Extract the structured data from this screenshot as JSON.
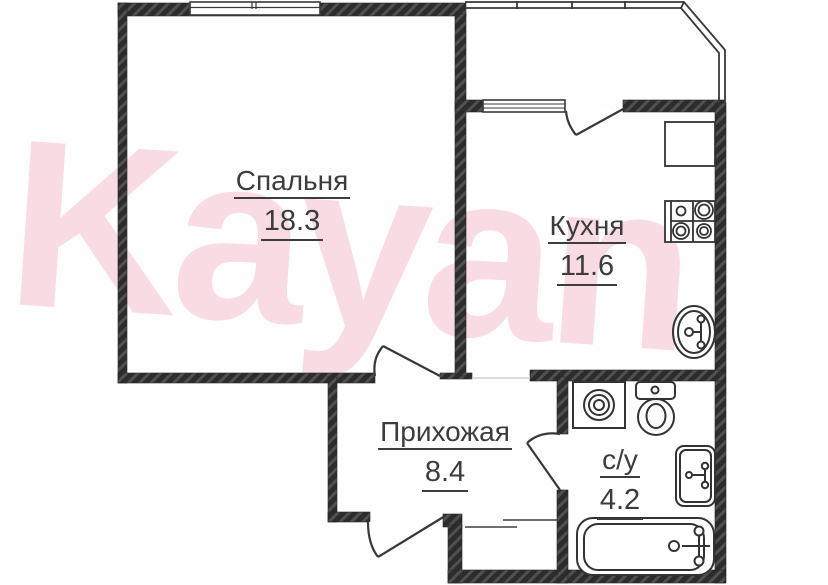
{
  "watermark": {
    "text": "Kayan",
    "color": "#f8dbe3"
  },
  "plan": {
    "type": "apartment-floor-plan",
    "rooms": [
      {
        "name": "Спальня",
        "area": "18.3"
      },
      {
        "name": "Кухня",
        "area": "11.6"
      },
      {
        "name": "Прихожая",
        "area": "8.4"
      },
      {
        "name": "с/у",
        "area": "4.2"
      }
    ],
    "fixtures": [
      "stove-icon",
      "kitchen-counter",
      "kitchen-sink-icon",
      "washing-machine-icon",
      "toilet-icon",
      "wash-basin-icon",
      "bathtub-icon"
    ],
    "features": [
      "bedroom-window",
      "kitchen-window",
      "balcony-glazing",
      "bedroom-door",
      "balcony-door",
      "bathroom-door",
      "entrance-door",
      "entrance-threshold"
    ]
  },
  "colors": {
    "wall": "#2c2c2c",
    "wall_hatch": "#505050",
    "line": "#383838",
    "label_text": "#3c3c3c",
    "watermark_pink": "#f8dbe3",
    "background": "#fefefe"
  }
}
